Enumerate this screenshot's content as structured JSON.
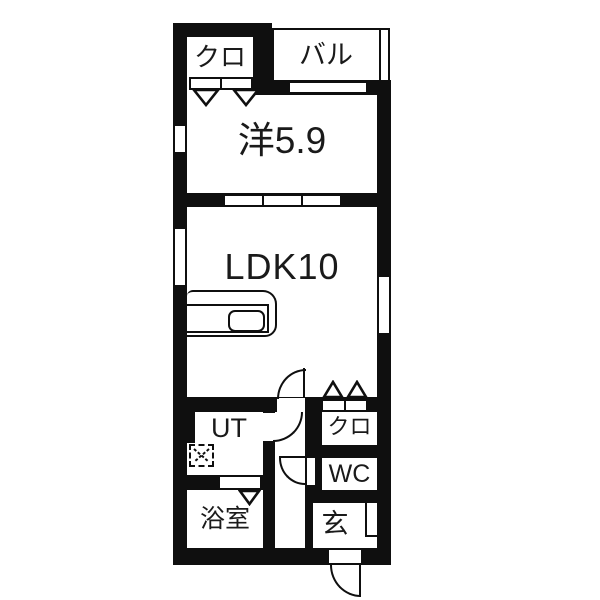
{
  "plan": {
    "type": "apartment-floor-plan",
    "rooms": {
      "closet_top": {
        "label": "クロ"
      },
      "balcony": {
        "label": "バル"
      },
      "western_room": {
        "label": "洋5.9"
      },
      "ldk": {
        "label": "LDK10"
      },
      "utility": {
        "label": "UT"
      },
      "closet_bottom": {
        "label": "クロ"
      },
      "toilet": {
        "label": "WC"
      },
      "bathroom": {
        "label": "浴室"
      },
      "entrance": {
        "label": "玄"
      }
    }
  },
  "colors": {
    "wall": "#0f0f0f",
    "floor": "#ffffff",
    "text": "#1a1a1a"
  }
}
